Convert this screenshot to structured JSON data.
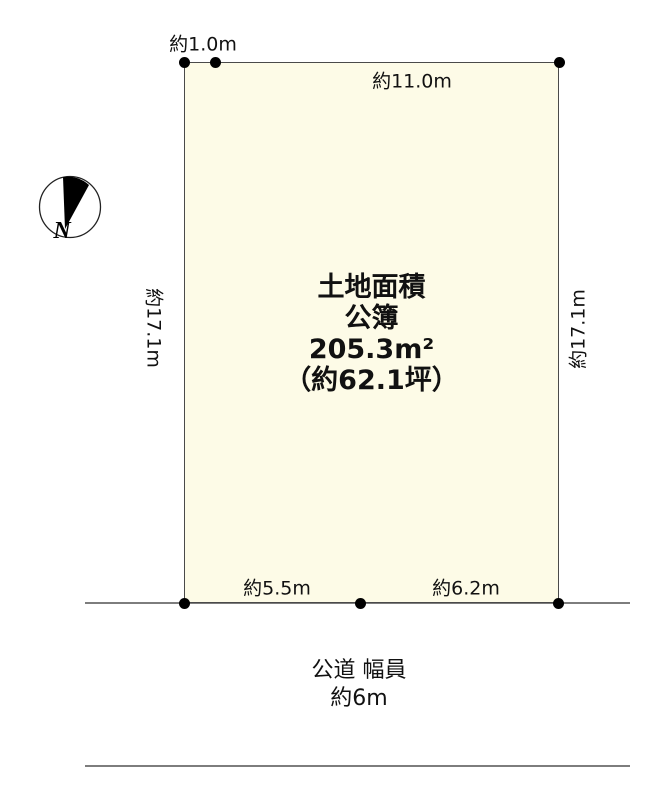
{
  "parcel": {
    "area_label": "土地面積",
    "register_type": "公簿",
    "area_sqm": "205.3m²",
    "area_tsubo": "（約62.1坪）",
    "edge_top_left": "約1.0m",
    "edge_top": "約11.0m",
    "edge_left": "約17.1m",
    "edge_right": "約17.1m",
    "edge_bottom_left": "約5.5m",
    "edge_bottom_right": "約6.2m"
  },
  "road": {
    "name": "公道 幅員",
    "width": "約6m"
  },
  "compass": {
    "north": "N"
  },
  "colors": {
    "parcel_fill": "#fdfbe7",
    "parcel_border": "#4a4a4a",
    "road_line": "#7d7d7d",
    "dot": "#000000",
    "ink": "#111111"
  }
}
